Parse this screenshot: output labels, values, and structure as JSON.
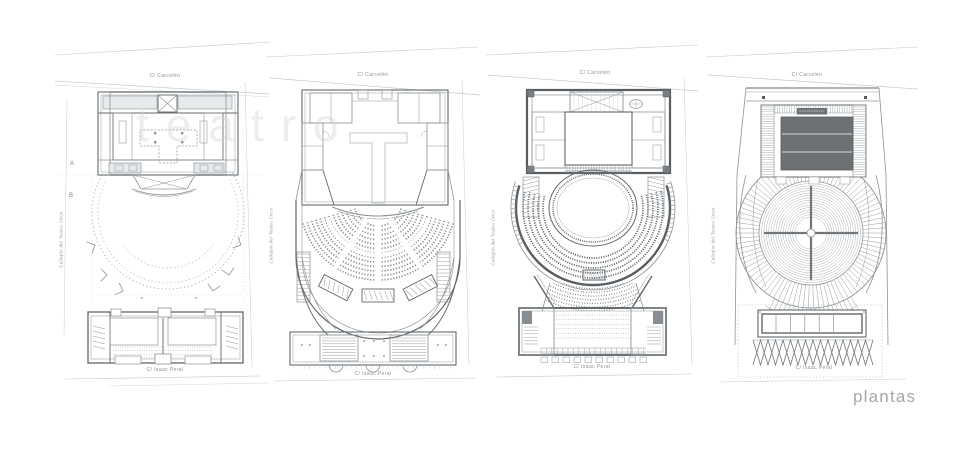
{
  "caption": {
    "text": "plantas"
  },
  "watermark": {
    "text": "teatro"
  },
  "section_markers": {
    "a": "A",
    "b": "B"
  },
  "plans": [
    {
      "street_top": "C/ Carcelén",
      "street_bottom": "C/ Isaac Peral",
      "street_side": "Callejón del Teatro Circo"
    },
    {
      "street_top": "C/ Carcelén",
      "street_bottom": "C/ Isaac Peral",
      "street_side": "Callejón del Teatro Circo"
    },
    {
      "street_top": "C/ Carcelén",
      "street_bottom": "C/ Isaac Peral",
      "street_side": "Callejón del Teatro Circo"
    },
    {
      "street_top": "C/ Carcelén",
      "street_bottom": "C/ Isaac Peral",
      "street_side": "Callejón del Teatro Circo"
    }
  ],
  "colors": {
    "background": "#ffffff",
    "line": "#8d9397",
    "wall_dark": "#62686c",
    "wall_darker": "#575d61",
    "line_faint": "#c5cacd",
    "poche_light": "#e7eaeb",
    "roof_dark": "#6e7174",
    "label_text": "#8a9094",
    "caption_text": "#a7a7a7",
    "watermark_text": "#cfd1d2"
  }
}
